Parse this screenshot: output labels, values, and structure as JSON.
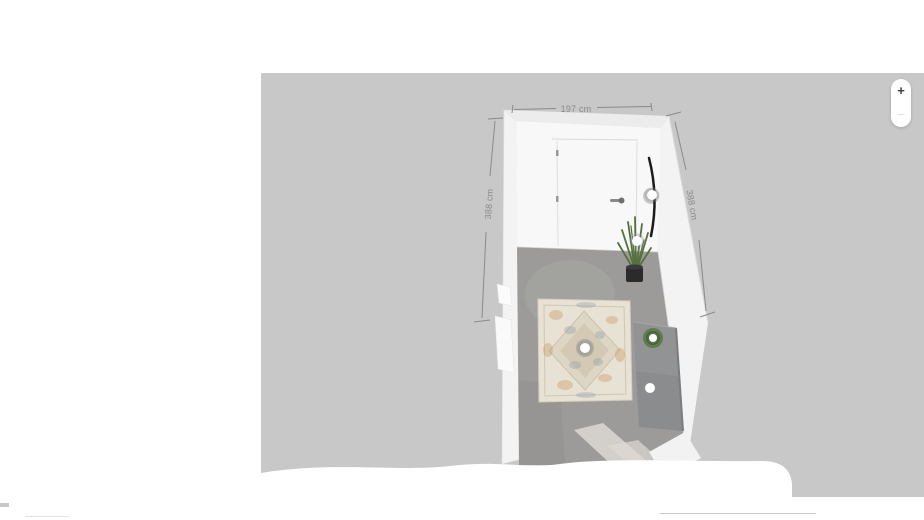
{
  "canvas": {
    "zoom_in_label": "+",
    "zoom_out_label": "−"
  },
  "dimensions": {
    "width_label": "197 cm",
    "left_depth_label": "388 cm",
    "right_depth_label": "388 cm"
  },
  "room": {
    "items": [
      {
        "name": "door"
      },
      {
        "name": "wall-mirror"
      },
      {
        "name": "potted-plant"
      },
      {
        "name": "rug"
      },
      {
        "name": "sideboard"
      },
      {
        "name": "plant-pot-on-sideboard"
      }
    ]
  },
  "colors": {
    "canvas_bg": "#c8c8c8",
    "wall_white": "#f8f8f8",
    "wall_top": "#ececec",
    "wall_side": "#f3f3f3",
    "floor_gray": "#9c9b99",
    "floor_light": "#d9d6d0",
    "rug_base": "#e8e2d5",
    "rug_accent_tan": "#c9965e",
    "rug_accent_blue": "#8298a3",
    "sideboard_gray": "#919394",
    "sideboard_dark": "#8a8c8e",
    "plant_green": "#55703f",
    "pot_black": "#2b2b2b",
    "mirror_black": "#1c1c1c",
    "marker_white": "#ffffff",
    "dimension_gray": "#8a8a8a"
  }
}
